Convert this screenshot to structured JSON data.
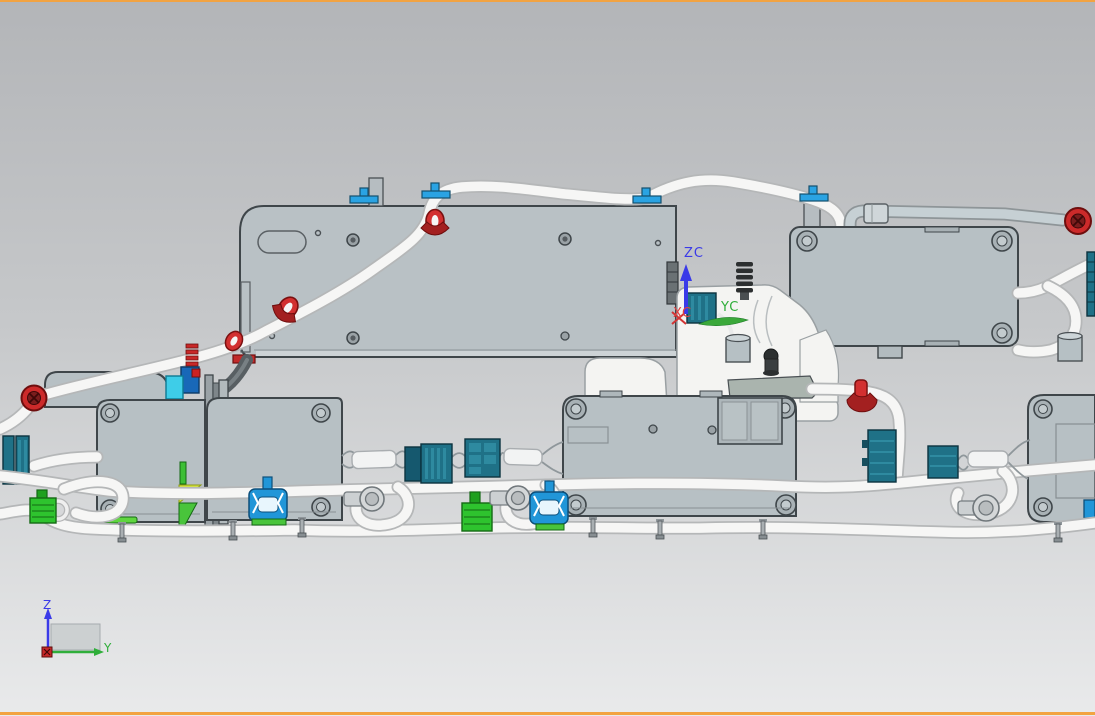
{
  "wcs": {
    "zc": "ZC",
    "yc": "YC",
    "xc": "XC"
  },
  "view_triad": {
    "z": "Z",
    "y": "Y"
  },
  "palette": {
    "bg_top": "#b3b5b8",
    "bg_bottom": "#e9eaeb",
    "viewport_border": "#f2a341",
    "panel_fill": "#b9c1c5",
    "module_fill": "#b7c0c4",
    "module_edge": "#3f464a",
    "part_white": "#f4f4f2",
    "part_white_edge": "#9aa0a3",
    "tube_core": "#f6f6f5",
    "tube_edge": "#b5b7b8",
    "tube_gray": "#c6d0d4",
    "tube_gray_edge": "#8e9598",
    "clamp_red": "#d23030",
    "clamp_red_dark": "#a32020",
    "grommet_red": "#cc2a2a",
    "clip_blue": "#2aa3e3",
    "bracket_blue": "#2196d8",
    "connector_teal": "#1f7187",
    "connector_teal_dark": "#0c333f",
    "connector_teal_light": "#2e8aa0",
    "connector_green": "#2ec32e",
    "connector_green_dark": "#146914",
    "wedge_yellow": "#d6e53c",
    "wedge_green": "#49c43b",
    "cyan_clip": "#3ecde8",
    "axis_z_blue": "#3a3ae8",
    "axis_y_green": "#2fae3a",
    "axis_x_red": "#e04040",
    "dark_part": "#2c2f30",
    "rail_gray": "#9aa2a6",
    "metal_gray": "#ccd0d2"
  }
}
